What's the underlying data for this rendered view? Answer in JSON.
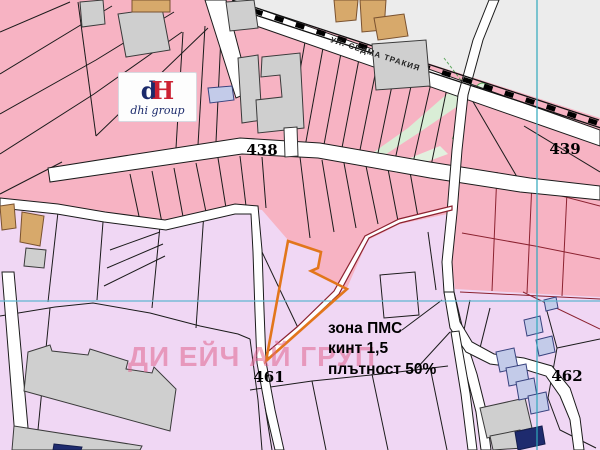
{
  "map": {
    "labels": {
      "parcel_438": "438",
      "parcel_439": "439",
      "parcel_461": "461",
      "parcel_462": "462"
    },
    "zone_annotation": {
      "line1": "зона ПМС",
      "line2": "кинт 1,5",
      "line3": "плътност 50%"
    },
    "street_label": "УЛ. СЕДМА ТРАКИЯ",
    "watermark": "ДИ ЕЙЧ АЙ ГРУП",
    "logo": {
      "mark_d": "d",
      "mark_h": "H",
      "name": "dhi group"
    },
    "colors": {
      "zone_pink": "#F7B3C3",
      "zone_lavender": "#F0D7F4",
      "corridor_gray": "#ECECEC",
      "road_white": "#FFFFFF",
      "parcel_line_black": "#1B1B1B",
      "boundary_maroon": "#8B2230",
      "highlight_orange": "#E2761B",
      "grid_teal": "#2FA8BC",
      "green_area": "#D9EDD6",
      "building_gray": "#CFCFCF",
      "building_tan": "#D7A96B",
      "building_blue": "#C3CBE9",
      "building_navy": "#1E2B6E",
      "watermark_pink": "#E0648E",
      "logo_navy": "#1B2A6B",
      "logo_red": "#CC2233"
    }
  }
}
